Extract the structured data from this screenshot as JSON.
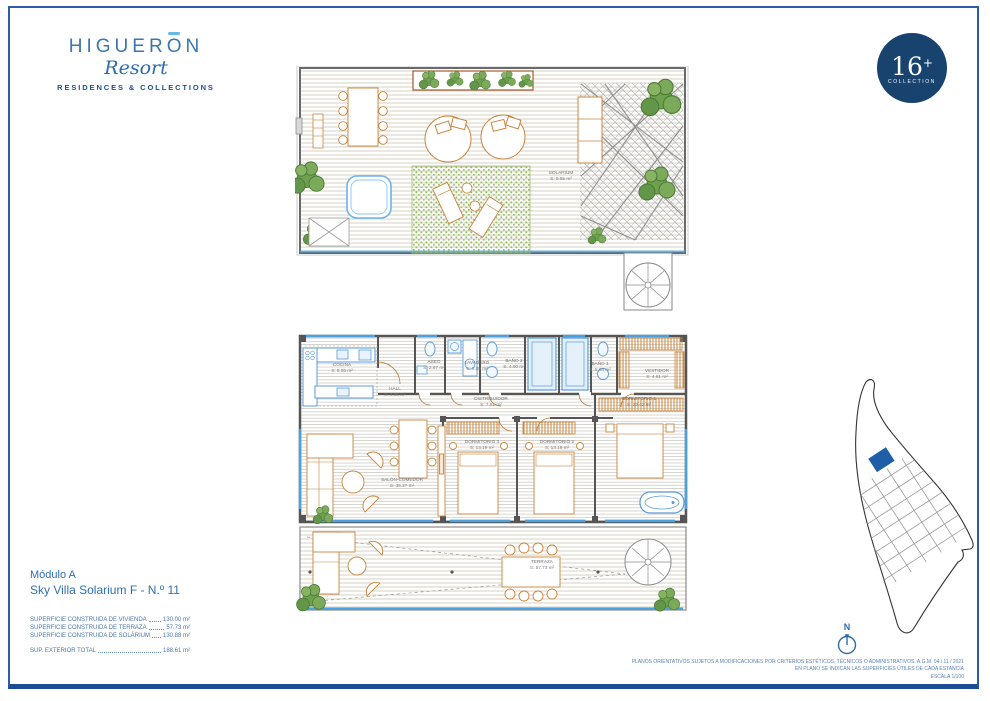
{
  "header": {
    "logo": {
      "name_start": "HIGUER",
      "name_accent_letter": "O",
      "name_end": "N",
      "script": "Resort",
      "tagline": "RESIDENCES & COLLECTIONS"
    },
    "badge": {
      "number": "16",
      "plus": "+",
      "label": "COLLECTION"
    }
  },
  "plans": {
    "upper": {
      "rooms": [
        {
          "name": "SOLARIUM",
          "area": "S: 9.55 m²"
        }
      ]
    },
    "lower": {
      "rooms": [
        {
          "name": "COCINA",
          "area": "S: 8.55 m²"
        },
        {
          "name": "HALL",
          "area": "S: 3.85 m²"
        },
        {
          "name": "ASEO",
          "area": "S: 2.67 m²"
        },
        {
          "name": "LAVADERO",
          "area": "S: 3.85 m²"
        },
        {
          "name": "BAÑO 2",
          "area": "S: 4.90 m²"
        },
        {
          "name": "BAÑO 1",
          "area": "S: 5.03 m²"
        },
        {
          "name": "VESTIDOR",
          "area": "S: 4.81 m²"
        },
        {
          "name": "DISTRIBUIDOR",
          "area": "S: 7.81 m²"
        },
        {
          "name": "DORMITORIO 1",
          "area": "S: 22.42 m²"
        },
        {
          "name": "DORMITORIO 3",
          "area": "S: 13.19 m²"
        },
        {
          "name": "DORMITORIO 2",
          "area": "S: 13.19 m²"
        },
        {
          "name": "SALÓN-COMEDOR",
          "area": "S: 35.27 m²"
        },
        {
          "name": "TERRAZA",
          "area": "S: 57.73 m²"
        }
      ]
    }
  },
  "title": {
    "line1": "Módulo A",
    "line2": "Sky Villa Solarium F - N.º 11"
  },
  "surfaces": {
    "items": [
      {
        "label": "SUPERFICIE CONSTRUIDA DE VIVIENDA",
        "value": "130.00 m²"
      },
      {
        "label": "SUPERFICIE CONSTRUIDA DE TERRAZA",
        "value": "57.73 m²"
      },
      {
        "label": "SUPERFICIE CONSTRUIDA DE SOLÁRIUM",
        "value": "130.88 m²"
      }
    ],
    "total": {
      "label": "SUP. EXTERIOR TOTAL",
      "value": "188.61 m²"
    }
  },
  "compass": {
    "label": "N"
  },
  "footer": {
    "lines": [
      "PLANOS ORIENTATIVOS SUJETOS A MODIFICACIONES POR CRITERIOS ESTÉTICOS, TÉCNICOS O ADMINISTRATIVOS. A.G.M. 04 / 11 / 2021",
      "EN PLANO SE INDICAN LAS SUPERFICIES ÚTILES DE CADA ESTANCIA",
      "ESCALA 1/100"
    ]
  },
  "colors": {
    "brand_blue": "#2d6ca8",
    "badge_navy": "#17436e",
    "frame_blue": "#2b5da6",
    "furniture_orange": "#c8843c",
    "fixture_blue": "#5b9bd5",
    "window_blue": "#4aa3e0",
    "plant_green": "#6da14f",
    "highlight_unit_blue": "#1f5fa8"
  }
}
